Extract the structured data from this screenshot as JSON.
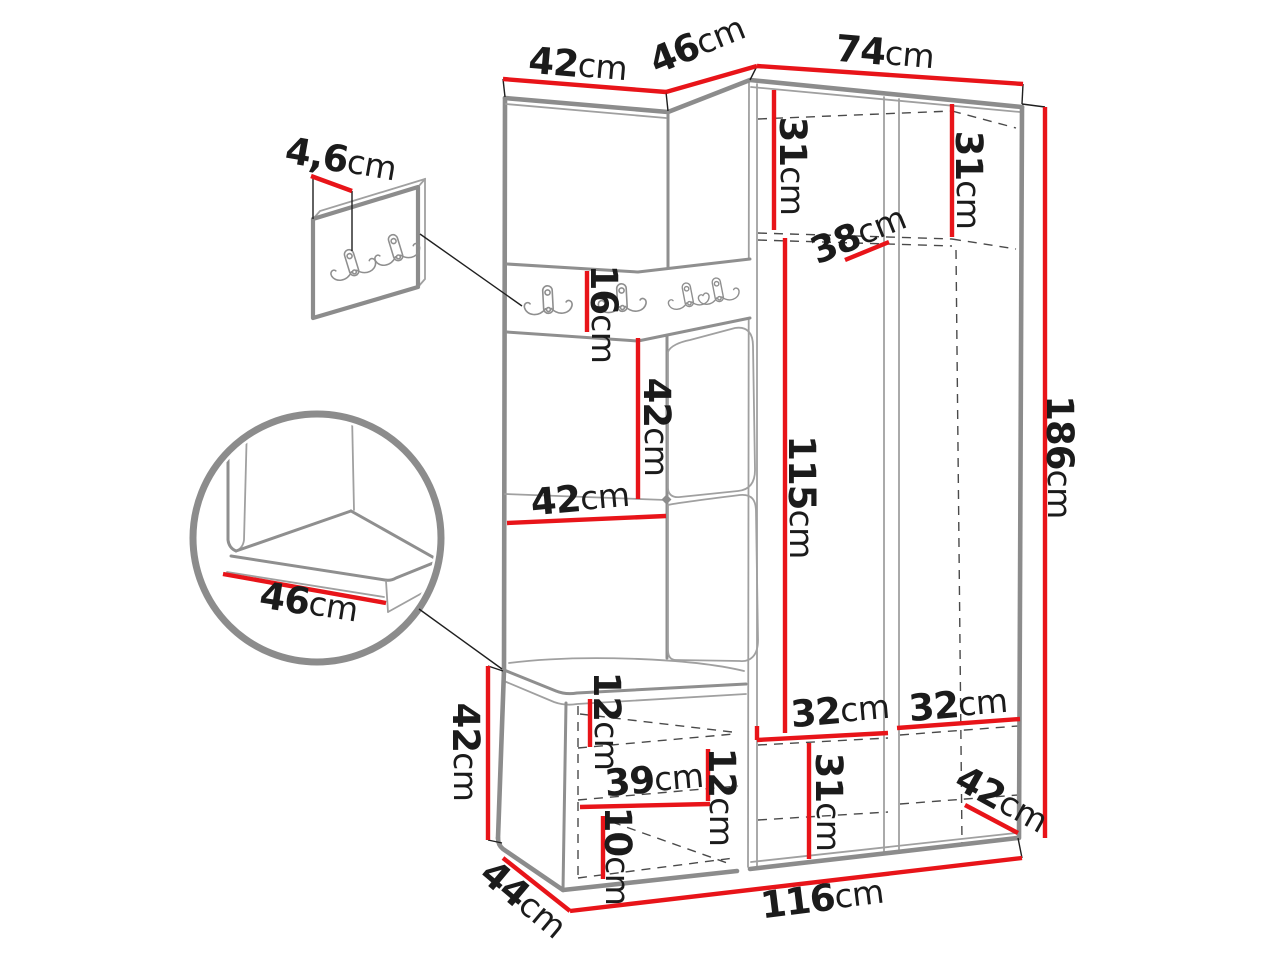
{
  "diagram": {
    "subject": "corner hallway wardrobe set with coat hooks and bench - dimension drawing",
    "unit": "cm",
    "colors": {
      "dimension_line": "#e81419",
      "drawing_line": "#8c8c8c",
      "label_text": "#1b1b1b"
    },
    "dims": {
      "top_width_left": {
        "value": "42",
        "unit": "cm"
      },
      "top_width_corner": {
        "value": "46",
        "unit": "cm"
      },
      "top_width_right": {
        "value": "74",
        "unit": "cm"
      },
      "hook_panel_thickness": {
        "value": "4,6",
        "unit": "cm"
      },
      "upper_shelf_left_height": {
        "value": "31",
        "unit": "cm"
      },
      "upper_shelf_right_height": {
        "value": "31",
        "unit": "cm"
      },
      "upper_shelf_depth": {
        "value": "38",
        "unit": "cm"
      },
      "hook_strip_height": {
        "value": "16",
        "unit": "cm"
      },
      "mid_panel_height": {
        "value": "42",
        "unit": "cm"
      },
      "mid_panel_width": {
        "value": "42",
        "unit": "cm"
      },
      "interior_height": {
        "value": "115",
        "unit": "cm"
      },
      "total_height": {
        "value": "186",
        "unit": "cm"
      },
      "seat_depth_detail": {
        "value": "46",
        "unit": "cm"
      },
      "bench_height": {
        "value": "42",
        "unit": "cm"
      },
      "bench_depth": {
        "value": "44",
        "unit": "cm"
      },
      "bench_top_clearance": {
        "value": "12",
        "unit": "cm"
      },
      "bench_shelf_width": {
        "value": "39",
        "unit": "cm"
      },
      "bench_shelf_spacing": {
        "value": "12",
        "unit": "cm"
      },
      "bench_bottom_clearance": {
        "value": "10",
        "unit": "cm"
      },
      "lower_compartment_height": {
        "value": "31",
        "unit": "cm"
      },
      "lower_compartment_left_width": {
        "value": "32",
        "unit": "cm"
      },
      "lower_compartment_right_width": {
        "value": "32",
        "unit": "cm"
      },
      "wardrobe_side_depth": {
        "value": "42",
        "unit": "cm"
      },
      "total_width": {
        "value": "116",
        "unit": "cm"
      }
    }
  }
}
